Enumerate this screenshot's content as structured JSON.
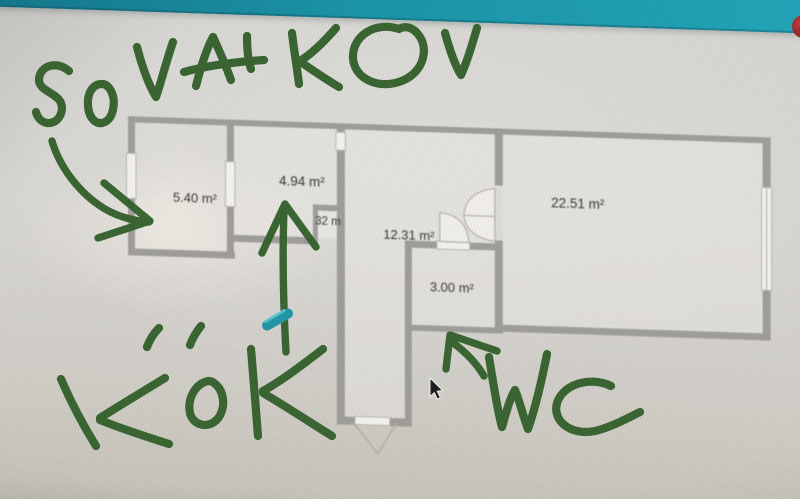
{
  "app_bar": {
    "color": "#1392a6"
  },
  "notification_dot": {
    "color": "#9e1b22"
  },
  "floor_plan": {
    "wall_color": "#9d9b97",
    "rooms": [
      {
        "name": "bedroom-left",
        "area_label": "5.40 m²"
      },
      {
        "name": "bedroom-mid",
        "area_label": "4.94 m²"
      },
      {
        "name": "closet",
        "area_label": "32 m"
      },
      {
        "name": "hallway",
        "area_label": "12.31 m²"
      },
      {
        "name": "wc",
        "area_label": "3.00 m²"
      },
      {
        "name": "living-room",
        "area_label": "22.51 m²"
      }
    ]
  },
  "annotations": {
    "marker_color": "#2d5c25",
    "highlight_color": "#1b93a5",
    "items": [
      {
        "label": "SOVALKOV"
      },
      {
        "label": "KÖK"
      },
      {
        "label": "WC"
      }
    ]
  }
}
